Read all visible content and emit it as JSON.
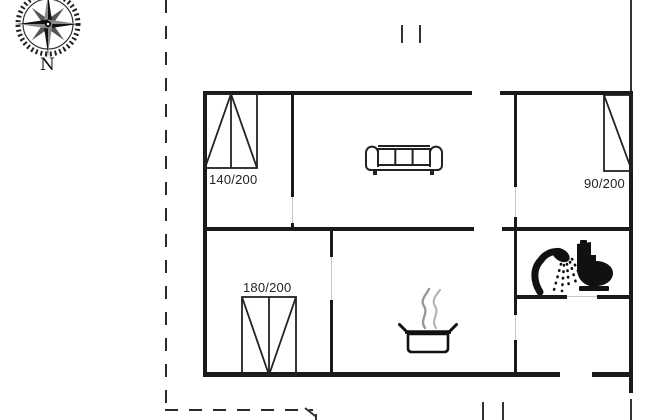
{
  "compass": {
    "label": "N"
  },
  "labels": {
    "bed_top_left": "140/200",
    "bed_top_right": "90/200",
    "bed_bottom_left": "180/200"
  },
  "icons": {
    "compass-rose-icon": "compass rose, north indicator",
    "sofa-icon": "three-seat sofa in living room",
    "cooking-pot-icon": "steaming cooking pot in kitchen",
    "shower-icon": "shower head in bathroom",
    "toilet-icon": "toilet in bathroom",
    "bed-icon": "bed symbol with size label",
    "gate-marks-icon": "opening markers on plot boundary"
  },
  "colors": {
    "wall": "#1a1a1a",
    "label_text": "#242424",
    "steam_gray": "#9e9e9e",
    "boundary_dash": "#2a2a2a",
    "background": "#ffffff"
  }
}
